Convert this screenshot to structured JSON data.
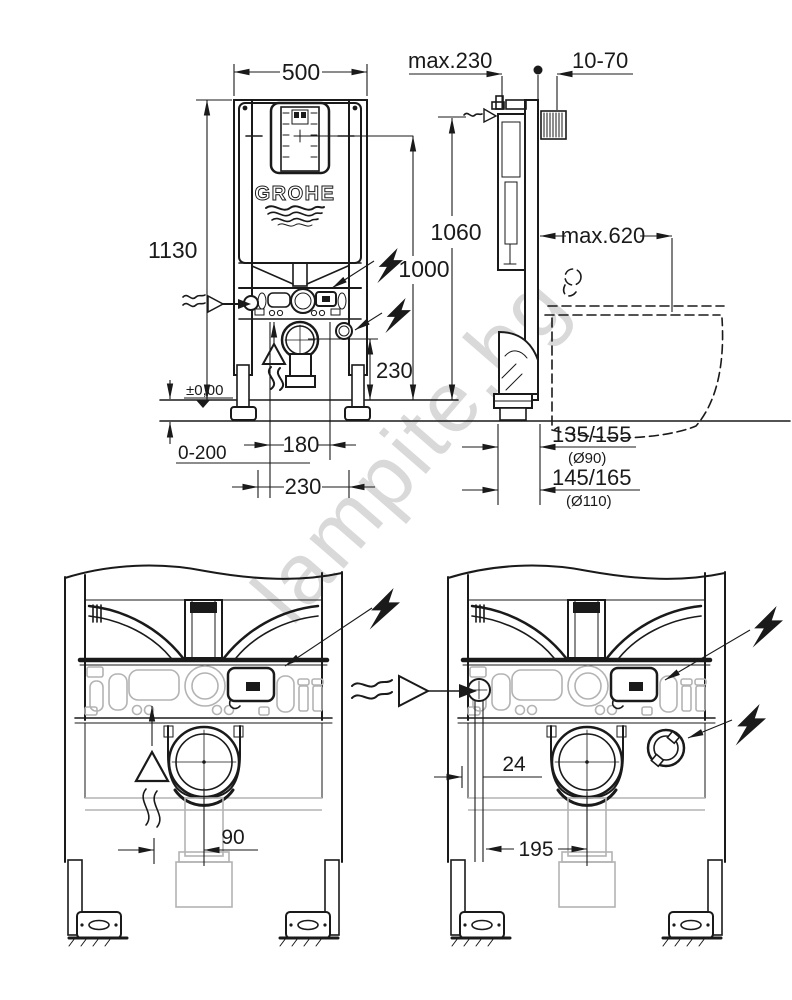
{
  "watermark": {
    "text": "lampite.bg"
  },
  "brand": {
    "logo_text": "GROHE"
  },
  "front_view": {
    "width": "500",
    "total_height": "1130",
    "top_edge_height": "1060",
    "shaft_center_height": "1000",
    "outlet_center_height": "230",
    "floor_level": "±0,00",
    "floor_adjust_range": "0-200",
    "spacing_180": "180",
    "spacing_230": "230"
  },
  "side_view": {
    "frame_depth": "max.230",
    "wall_distance": "10-70",
    "projection": "max.620",
    "outlet_d90_height": "135/155",
    "outlet_d90_pipe": "(Ø90)",
    "outlet_d110_height": "145/165",
    "outlet_d110_pipe": "(Ø110)"
  },
  "detail_left": {
    "supply_to_center": "90"
  },
  "detail_right": {
    "inlet_offset": "24",
    "inlet_to_center": "195"
  }
}
